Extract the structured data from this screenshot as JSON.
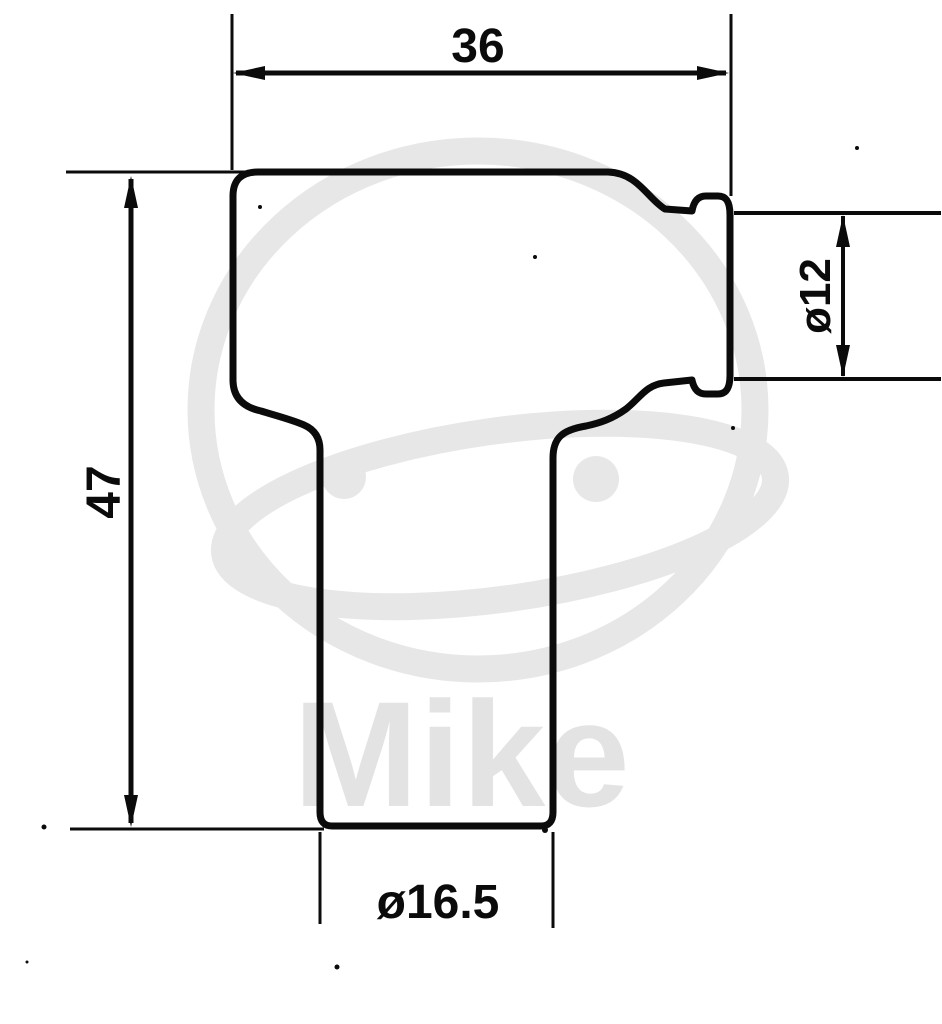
{
  "page": {
    "background_color": "#ffffff",
    "line_color": "#0b0b0b"
  },
  "watermark": {
    "text": "Mike",
    "logo_color": "#e7e7e7",
    "text_color": "#e3e3e3"
  },
  "dimensions": {
    "top_width": {
      "label": "36",
      "orientation": "horizontal"
    },
    "left_height": {
      "label": "47",
      "orientation": "vertical"
    },
    "terminal_diameter": {
      "label": "ø12",
      "orientation": "vertical"
    },
    "stem_diameter": {
      "label": "ø16.5",
      "orientation": "horizontal"
    }
  }
}
